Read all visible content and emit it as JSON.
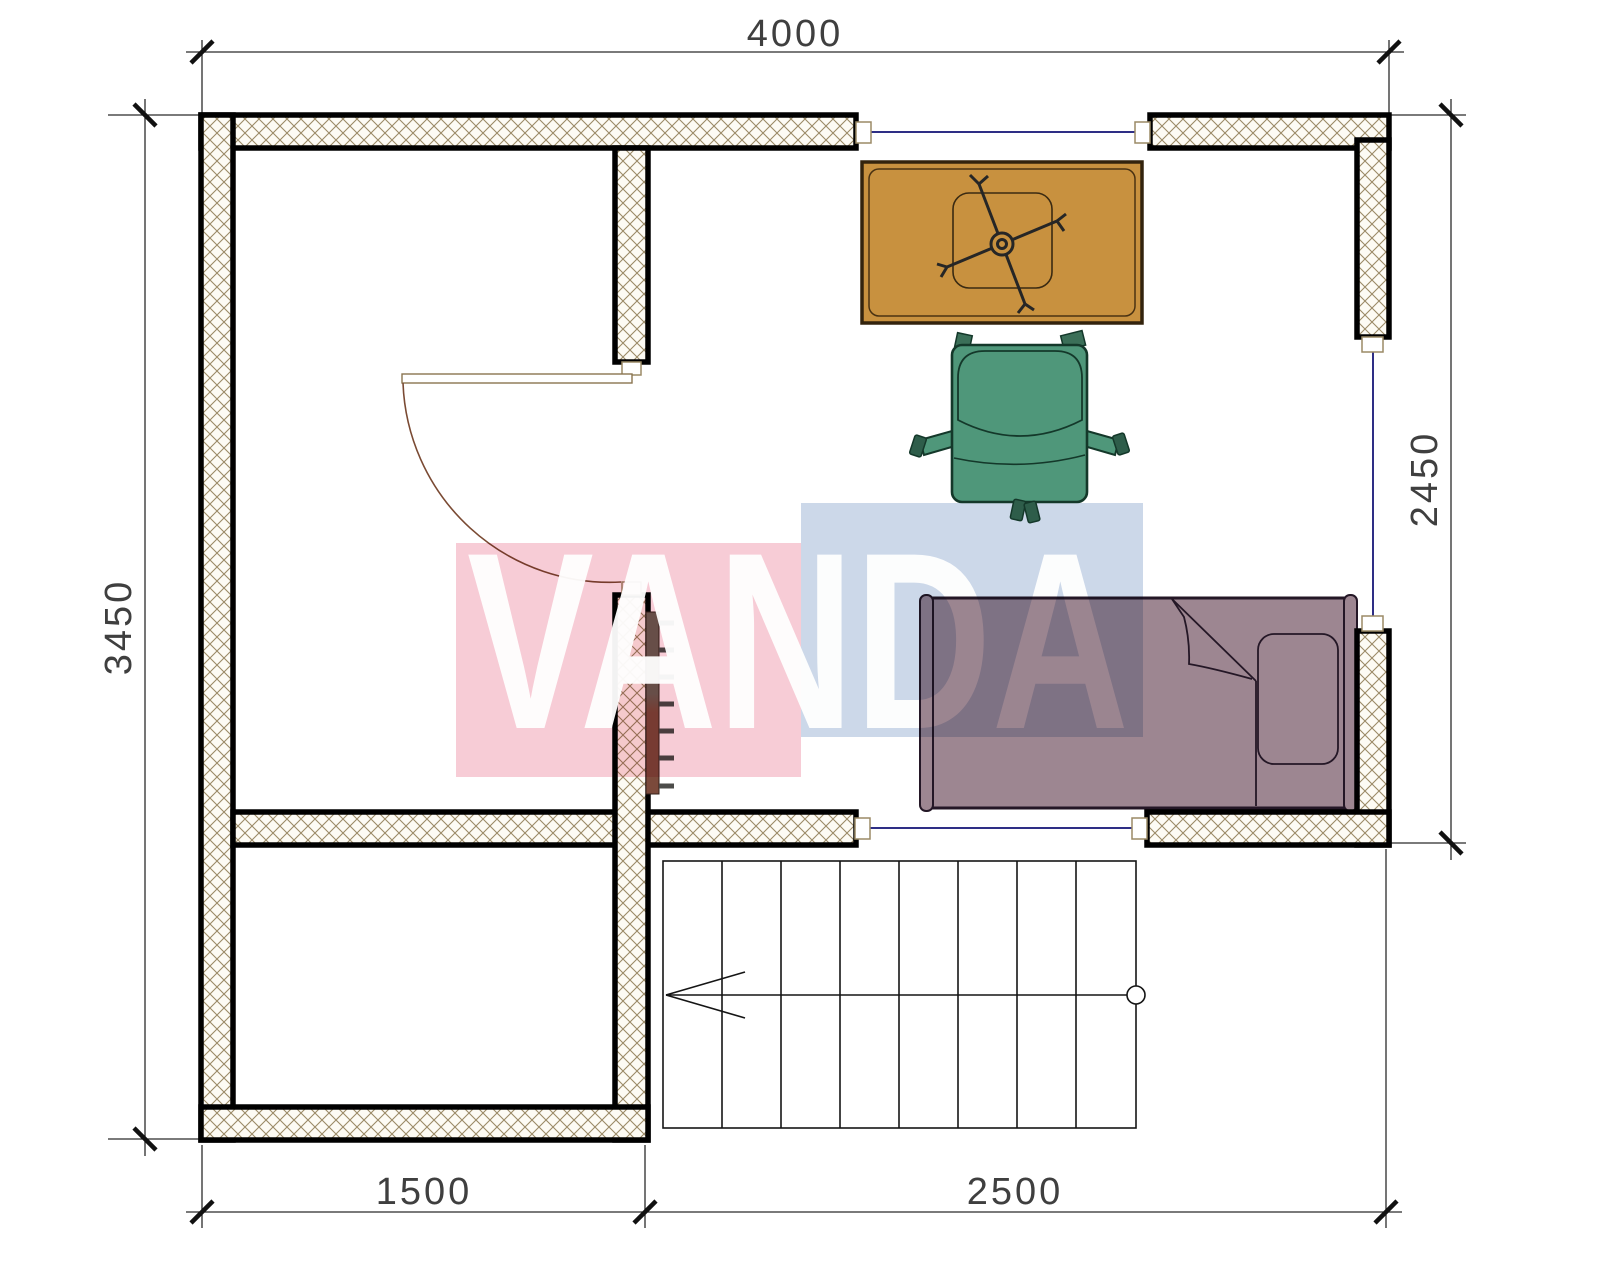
{
  "title": "floor-plan-drawing",
  "watermark": {
    "text": "VANDA",
    "pink_color": "#f7ccd6",
    "blue_color": "#ccd8e9",
    "letter_color": "#ffffff"
  },
  "dimensions": {
    "top_width": "4000",
    "left_height": "3450",
    "right_height": "2450",
    "bottom_left_width": "1500",
    "bottom_right_width": "2500"
  },
  "plan": {
    "wall_fill": "#fdfbf4",
    "wall_hatch_color": "#9b8a66",
    "wall_face_color": "#000000",
    "window_color": "#2e2e85",
    "door_arc_color": "#7a4a33",
    "dimension_line_color": "#2b2b2b",
    "stairs": {
      "treads": 8,
      "direction_arrow": "left",
      "walkline_marker": "circle"
    },
    "furniture": [
      {
        "name": "desk",
        "color": "#c8913f"
      },
      {
        "name": "chair-cross-base",
        "color": "#c8913f"
      },
      {
        "name": "armchair",
        "color": "#4f977a"
      },
      {
        "name": "bed",
        "color": "#9d8691"
      },
      {
        "name": "radiator",
        "color": "#7b4a3b"
      }
    ]
  }
}
